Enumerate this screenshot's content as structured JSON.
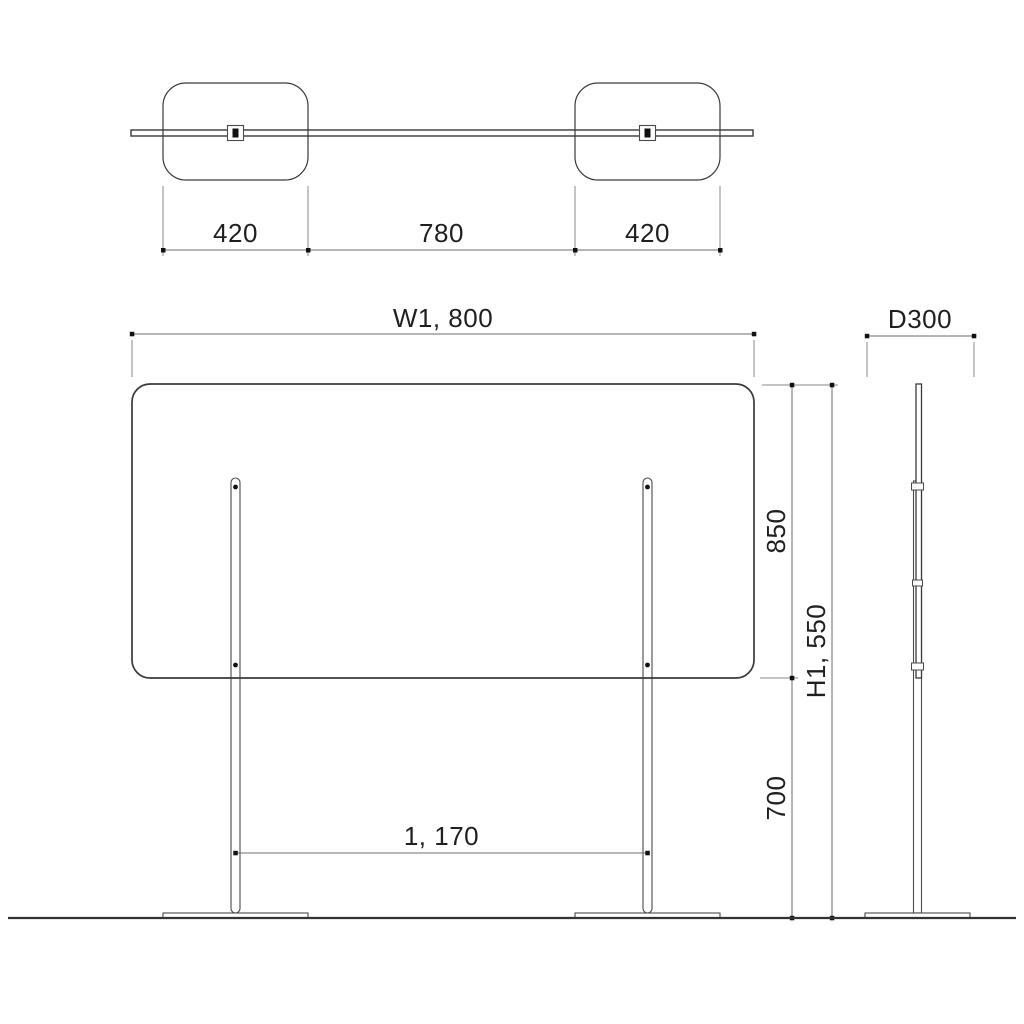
{
  "drawing": {
    "top_view": {
      "dim_left_base": "420",
      "dim_center_span": "780",
      "dim_right_base": "420"
    },
    "front_view": {
      "dim_width": "W1, 800",
      "dim_panel_height": "850",
      "dim_total_height": "H1, 550",
      "dim_leg_height": "700",
      "dim_leg_span": "1, 170"
    },
    "side_view": {
      "dim_depth": "D300"
    }
  },
  "colors": {
    "background": "#ffffff",
    "object_line": "#3a3a3a",
    "dimension_line": "#6e6e6e",
    "extension_line": "#8a8a8a",
    "text": "#1f1f1f"
  }
}
